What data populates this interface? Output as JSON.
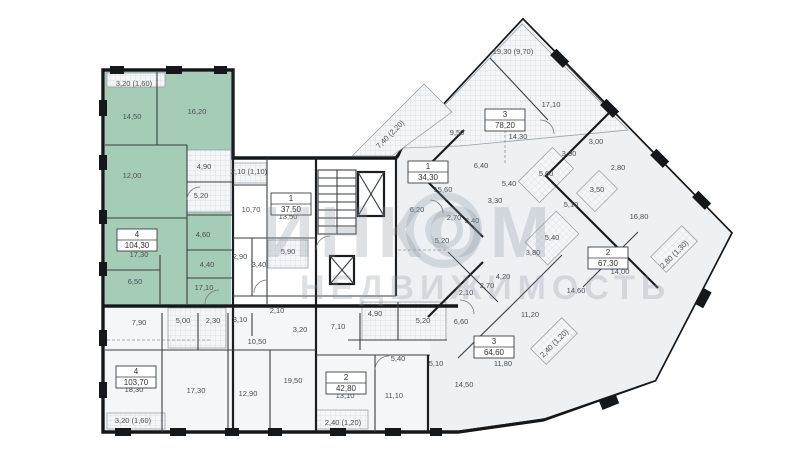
{
  "watermark": {
    "brand": "ИНКОМ",
    "subtitle": "НЕДВИЖИМОСТЬ"
  },
  "colors": {
    "highlight_apartment": "#a4ccb6",
    "wing_floor": "#eef1f4",
    "wall": "#15181a",
    "label_text": "#4a5056",
    "watermark_gray": "#8a96a0"
  },
  "apartments": [
    {
      "type": "4",
      "area": "104,30",
      "x": 137,
      "y": 240,
      "highlighted": true
    },
    {
      "type": "1",
      "area": "37,50",
      "x": 291,
      "y": 204,
      "highlighted": false
    },
    {
      "type": "4",
      "area": "103,70",
      "x": 136,
      "y": 377,
      "highlighted": false
    },
    {
      "type": "2",
      "area": "42,80",
      "x": 346,
      "y": 383,
      "highlighted": false
    },
    {
      "type": "3",
      "area": "64,60",
      "x": 494,
      "y": 347,
      "highlighted": false
    },
    {
      "type": "3",
      "area": "78,20",
      "x": 505,
      "y": 120,
      "highlighted": false
    },
    {
      "type": "1",
      "area": "34,30",
      "x": 428,
      "y": 172,
      "highlighted": false
    },
    {
      "type": "2",
      "area": "67,30",
      "x": 608,
      "y": 258,
      "highlighted": false
    }
  ],
  "room_labels": [
    {
      "text": "3,20 (1,60)",
      "x": 134,
      "y": 86,
      "rot": 0
    },
    {
      "text": "14,50",
      "x": 132,
      "y": 119,
      "rot": 0
    },
    {
      "text": "16,20",
      "x": 197,
      "y": 114,
      "rot": 0
    },
    {
      "text": "12,00",
      "x": 132,
      "y": 178,
      "rot": 0
    },
    {
      "text": "4,90",
      "x": 204,
      "y": 169,
      "rot": 0
    },
    {
      "text": "5,20",
      "x": 201,
      "y": 198,
      "rot": 0
    },
    {
      "text": "4,60",
      "x": 203,
      "y": 237,
      "rot": 0
    },
    {
      "text": "4,40",
      "x": 207,
      "y": 267,
      "rot": 0
    },
    {
      "text": "17,30",
      "x": 139,
      "y": 257,
      "rot": 0
    },
    {
      "text": "6,50",
      "x": 135,
      "y": 284,
      "rot": 0
    },
    {
      "text": "17,10",
      "x": 204,
      "y": 290,
      "rot": 0
    },
    {
      "text": "2,10 (1,10)",
      "x": 249,
      "y": 174,
      "rot": 0
    },
    {
      "text": "10,70",
      "x": 251,
      "y": 212,
      "rot": 0
    },
    {
      "text": "13,50",
      "x": 288,
      "y": 219,
      "rot": 0
    },
    {
      "text": "5,90",
      "x": 288,
      "y": 254,
      "rot": 0
    },
    {
      "text": "2,90",
      "x": 240,
      "y": 259,
      "rot": 0
    },
    {
      "text": "3,40",
      "x": 259,
      "y": 267,
      "rot": 0
    },
    {
      "text": "2,10",
      "x": 277,
      "y": 313,
      "rot": 0
    },
    {
      "text": "7,90",
      "x": 139,
      "y": 325,
      "rot": 0
    },
    {
      "text": "5,00",
      "x": 183,
      "y": 323,
      "rot": 0
    },
    {
      "text": "2,30",
      "x": 213,
      "y": 323,
      "rot": 0
    },
    {
      "text": "3,10",
      "x": 240,
      "y": 322,
      "rot": 0
    },
    {
      "text": "10,50",
      "x": 257,
      "y": 344,
      "rot": 0
    },
    {
      "text": "18,30",
      "x": 134,
      "y": 392,
      "rot": 0
    },
    {
      "text": "17,30",
      "x": 196,
      "y": 393,
      "rot": 0
    },
    {
      "text": "12,90",
      "x": 248,
      "y": 396,
      "rot": 0
    },
    {
      "text": "19,50",
      "x": 293,
      "y": 383,
      "rot": 0
    },
    {
      "text": "3,20 (1,60)",
      "x": 133,
      "y": 423,
      "rot": 0
    },
    {
      "text": "3,20",
      "x": 300,
      "y": 332,
      "rot": 0
    },
    {
      "text": "7,10",
      "x": 338,
      "y": 329,
      "rot": 0
    },
    {
      "text": "4,90",
      "x": 375,
      "y": 316,
      "rot": 0
    },
    {
      "text": "5,20",
      "x": 423,
      "y": 323,
      "rot": 0
    },
    {
      "text": "5,40",
      "x": 398,
      "y": 361,
      "rot": 0
    },
    {
      "text": "5,10",
      "x": 436,
      "y": 366,
      "rot": 0
    },
    {
      "text": "13,10",
      "x": 345,
      "y": 398,
      "rot": 0
    },
    {
      "text": "11,10",
      "x": 394,
      "y": 398,
      "rot": 0
    },
    {
      "text": "2,40 (1,20)",
      "x": 343,
      "y": 425,
      "rot": 0
    },
    {
      "text": "6,60",
      "x": 461,
      "y": 324,
      "rot": 0
    },
    {
      "text": "2,10",
      "x": 466,
      "y": 295,
      "rot": 0
    },
    {
      "text": "2,70",
      "x": 487,
      "y": 288,
      "rot": 0
    },
    {
      "text": "4,20",
      "x": 503,
      "y": 279,
      "rot": 0
    },
    {
      "text": "14,50",
      "x": 464,
      "y": 387,
      "rot": 0
    },
    {
      "text": "11,80",
      "x": 503,
      "y": 366,
      "rot": 0
    },
    {
      "text": "11,20",
      "x": 530,
      "y": 317,
      "rot": 0
    },
    {
      "text": "14,60",
      "x": 576,
      "y": 293,
      "rot": 0
    },
    {
      "text": "14,00",
      "x": 620,
      "y": 274,
      "rot": 0
    },
    {
      "text": "2,40 (1,20)",
      "x": 556,
      "y": 345,
      "rot": -45
    },
    {
      "text": "16,80",
      "x": 639,
      "y": 219,
      "rot": 0
    },
    {
      "text": "2,80 (1,30)",
      "x": 676,
      "y": 256,
      "rot": -45
    },
    {
      "text": "3,00",
      "x": 596,
      "y": 144,
      "rot": 0
    },
    {
      "text": "3,90",
      "x": 569,
      "y": 156,
      "rot": 0
    },
    {
      "text": "2,80",
      "x": 618,
      "y": 170,
      "rot": 0
    },
    {
      "text": "3,50",
      "x": 597,
      "y": 192,
      "rot": 0
    },
    {
      "text": "5,10",
      "x": 571,
      "y": 207,
      "rot": 0
    },
    {
      "text": "5,40",
      "x": 552,
      "y": 240,
      "rot": 0
    },
    {
      "text": "3,80",
      "x": 533,
      "y": 255,
      "rot": 0
    },
    {
      "text": "17,10",
      "x": 551,
      "y": 107,
      "rot": 0
    },
    {
      "text": "9,50",
      "x": 457,
      "y": 135,
      "rot": 0
    },
    {
      "text": "14,30",
      "x": 518,
      "y": 139,
      "rot": 0
    },
    {
      "text": "6,40",
      "x": 481,
      "y": 168,
      "rot": 0
    },
    {
      "text": "5,60",
      "x": 546,
      "y": 176,
      "rot": 0
    },
    {
      "text": "5,40",
      "x": 509,
      "y": 186,
      "rot": 0
    },
    {
      "text": "3,30",
      "x": 495,
      "y": 203,
      "rot": 0
    },
    {
      "text": "15,60",
      "x": 443,
      "y": 192,
      "rot": 0
    },
    {
      "text": "6,20",
      "x": 417,
      "y": 212,
      "rot": 0
    },
    {
      "text": "2,70",
      "x": 454,
      "y": 220,
      "rot": 0
    },
    {
      "text": "2,40",
      "x": 472,
      "y": 223,
      "rot": 0
    },
    {
      "text": "5,20",
      "x": 442,
      "y": 243,
      "rot": 0
    },
    {
      "text": "19,30 (9,70)",
      "x": 513,
      "y": 54,
      "rot": 0
    },
    {
      "text": "7,40 (2,20)",
      "x": 392,
      "y": 136,
      "rot": -45
    }
  ]
}
